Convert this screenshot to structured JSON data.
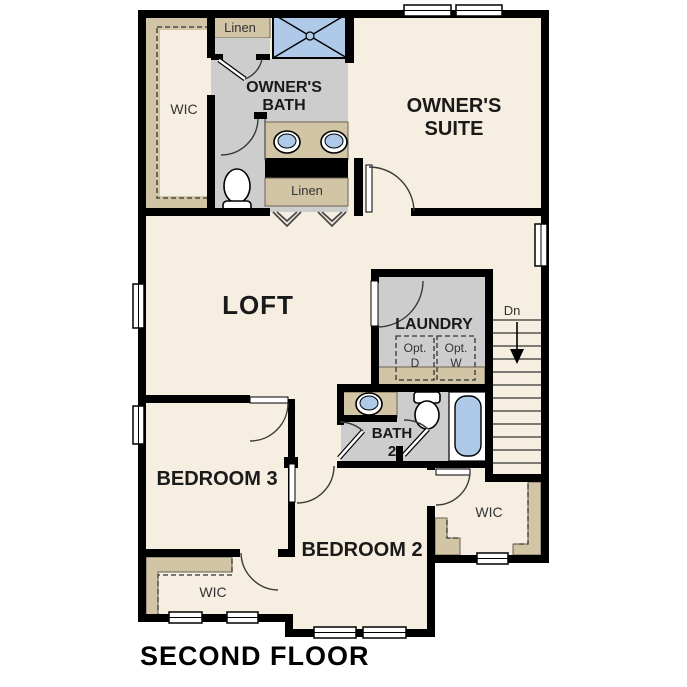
{
  "title": {
    "label": "SECOND FLOOR"
  },
  "colors": {
    "wall": "#000000",
    "floor": "#f6eee0",
    "shelf_tan": "#d2c5a6",
    "bath_floor_gray": "#cdcdcd",
    "fixture_blue": "#aecae8",
    "label_dark": "#1a1a1a",
    "label_small": "#333333"
  },
  "rooms": {
    "owners_wic": {
      "label": "WIC"
    },
    "linen_top": {
      "label": "Linen"
    },
    "owners_bath": {
      "line1": "OWNER'S",
      "line2": "BATH"
    },
    "owners_suite": {
      "line1": "OWNER'S",
      "line2": "SUITE"
    },
    "linen_mid": {
      "label": "Linen"
    },
    "loft": {
      "label": "LOFT"
    },
    "laundry": {
      "label": "LAUNDRY",
      "opt_d_line1": "Opt.",
      "opt_d_line2": "D",
      "opt_w_line1": "Opt.",
      "opt_w_line2": "W"
    },
    "stairs": {
      "down_label": "Dn"
    },
    "bath2": {
      "line1": "BATH",
      "line2": "2"
    },
    "bedroom3": {
      "label": "BEDROOM 3"
    },
    "bedroom2": {
      "label": "BEDROOM 2"
    },
    "bedroom3_wic": {
      "label": "WIC"
    },
    "bedroom2_wic": {
      "label": "WIC"
    }
  }
}
